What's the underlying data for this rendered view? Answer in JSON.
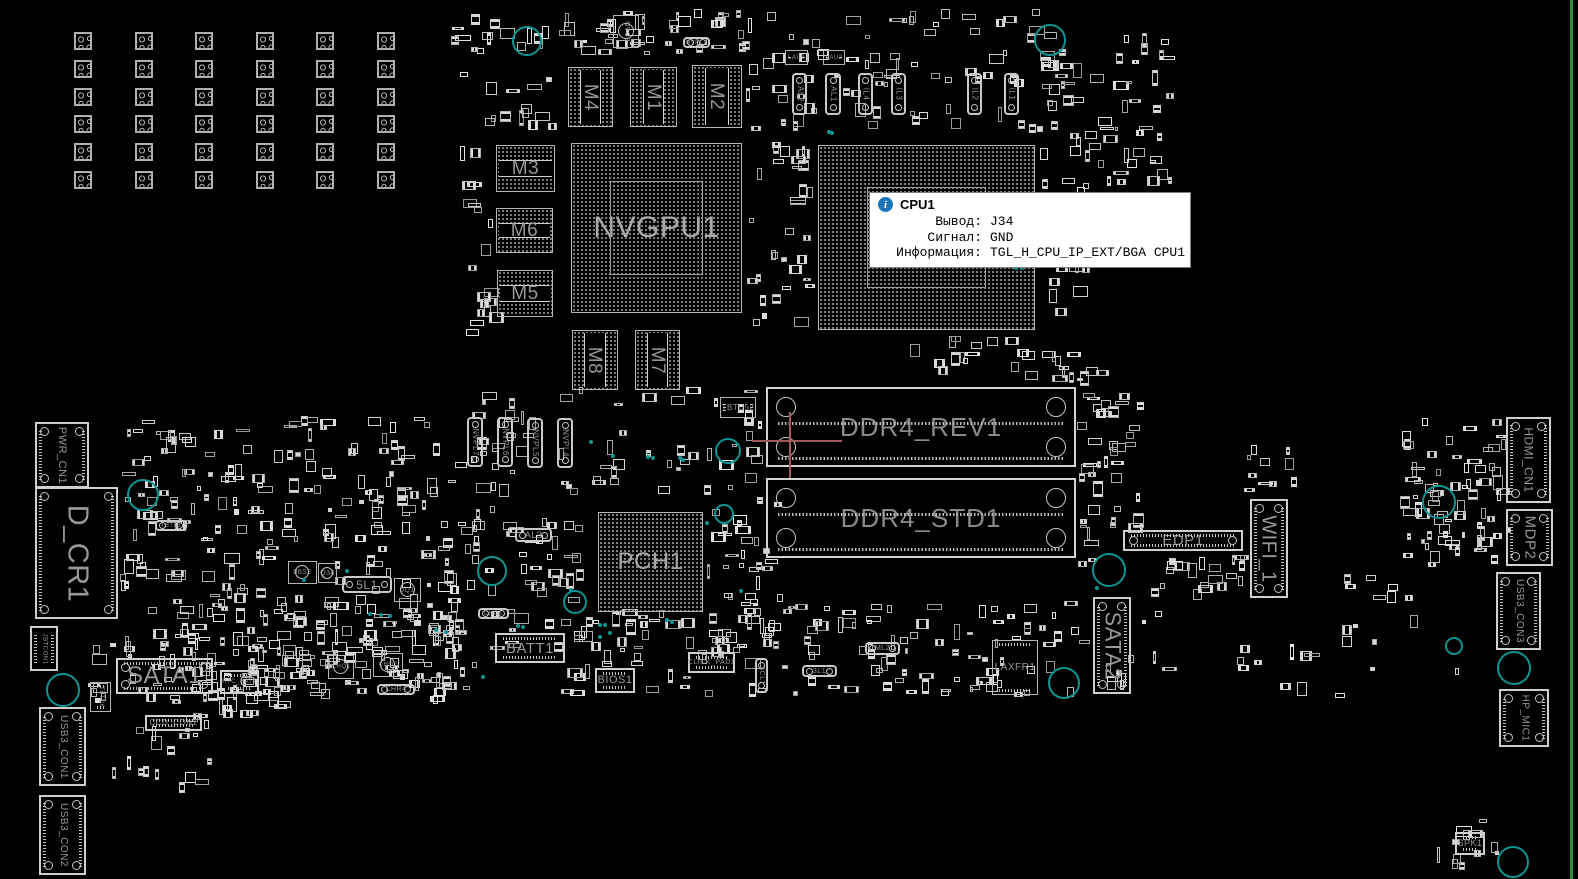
{
  "board": {
    "width": 1578,
    "height": 879,
    "bg": "#000000",
    "silk": "#c0c0c0",
    "label_color": "#989898",
    "teal": "#0d9494",
    "edge_green": "#2e8b2e",
    "crosshair_color": "#a05a5a"
  },
  "tooltip": {
    "title": "CPU1",
    "icon": "info-icon",
    "accent": "#1b75bb",
    "rows": [
      {
        "label": "Вывод:",
        "value": "J34"
      },
      {
        "label": "Сигнал:",
        "value": "GND"
      },
      {
        "label": "Информация:",
        "value": "TGL_H_CPU_IP_EXT/BGA CPU1"
      }
    ]
  },
  "pad_grid": {
    "x": 74,
    "y": 32,
    "cols": 6,
    "rows": 6,
    "dx": 60.5,
    "dy": 27.8,
    "size": 18
  },
  "crosshair": {
    "x": 790,
    "y": 441,
    "h": [
      752,
      440,
      90,
      2
    ],
    "v": [
      789,
      412,
      2,
      66
    ]
  },
  "edge_line": {
    "x": 1570,
    "w": 3
  },
  "components": [
    {
      "id": "nvgpu1",
      "label": "NVGPU1",
      "x": 571,
      "y": 143,
      "w": 171,
      "h": 170,
      "type": "bga",
      "lo": "h",
      "fs": 30,
      "inner": true
    },
    {
      "id": "cpu1",
      "label": "",
      "x": 818,
      "y": 145,
      "w": 217,
      "h": 185,
      "type": "bga",
      "lo": "h",
      "fs": 0,
      "inner": true
    },
    {
      "id": "pch1",
      "label": "PCH1",
      "x": 598,
      "y": 512,
      "w": 105,
      "h": 100,
      "type": "bga",
      "lo": "h",
      "fs": 24
    },
    {
      "id": "m4",
      "label": "M4",
      "x": 568,
      "y": 67,
      "w": 45,
      "h": 60,
      "type": "mem",
      "lo": "v",
      "fs": 19
    },
    {
      "id": "m1",
      "label": "M1",
      "x": 630,
      "y": 67,
      "w": 47,
      "h": 60,
      "type": "mem",
      "lo": "v",
      "fs": 19
    },
    {
      "id": "m2",
      "label": "M2",
      "x": 692,
      "y": 65,
      "w": 50,
      "h": 63,
      "type": "mem",
      "lo": "v",
      "fs": 19
    },
    {
      "id": "m3",
      "label": "M3",
      "x": 496,
      "y": 145,
      "w": 59,
      "h": 47,
      "type": "mem",
      "lo": "h",
      "fs": 19
    },
    {
      "id": "m6",
      "label": "M6",
      "x": 496,
      "y": 208,
      "w": 57,
      "h": 45,
      "type": "mem",
      "lo": "h",
      "fs": 19
    },
    {
      "id": "m5",
      "label": "M5",
      "x": 497,
      "y": 270,
      "w": 56,
      "h": 47,
      "type": "mem",
      "lo": "h",
      "fs": 19
    },
    {
      "id": "m8",
      "label": "M8",
      "x": 572,
      "y": 330,
      "w": 46,
      "h": 60,
      "type": "mem",
      "lo": "v",
      "fs": 19
    },
    {
      "id": "m7",
      "label": "M7",
      "x": 635,
      "y": 330,
      "w": 45,
      "h": 60,
      "type": "mem",
      "lo": "v",
      "fs": 19
    },
    {
      "id": "ddr4_rev1",
      "label": "DDR4_REV1",
      "x": 766,
      "y": 387,
      "w": 310,
      "h": 80,
      "type": "dimm",
      "lo": "h",
      "fs": 26
    },
    {
      "id": "ddr4_std1",
      "label": "DDR4_STD1",
      "x": 766,
      "y": 478,
      "w": 310,
      "h": 80,
      "type": "dimm",
      "lo": "h",
      "fs": 26
    },
    {
      "id": "sata1",
      "label": "SATA1",
      "x": 116,
      "y": 658,
      "w": 97,
      "h": 36,
      "type": "conn",
      "lo": "h",
      "fs": 24
    },
    {
      "id": "sata2",
      "label": "SATA2",
      "x": 1093,
      "y": 597,
      "w": 38,
      "h": 97,
      "type": "conn",
      "lo": "v",
      "fs": 22
    },
    {
      "id": "edp1",
      "label": "EDP1",
      "x": 1123,
      "y": 530,
      "w": 120,
      "h": 21,
      "type": "conn",
      "lo": "h",
      "fs": 15
    },
    {
      "id": "wifi_1",
      "label": "WIFI_1",
      "x": 1250,
      "y": 499,
      "w": 38,
      "h": 99,
      "type": "conn",
      "lo": "v",
      "fs": 20
    },
    {
      "id": "laxfr1",
      "label": "LAXFR1",
      "x": 992,
      "y": 640,
      "w": 46,
      "h": 55,
      "type": "chip",
      "lo": "h",
      "fs": 10
    },
    {
      "id": "d_cr1",
      "label": "D_CR1",
      "x": 35,
      "y": 487,
      "w": 83,
      "h": 132,
      "type": "conn",
      "lo": "v",
      "fs": 29
    },
    {
      "id": "pwr_cn1",
      "label": "PWR_CN1",
      "x": 35,
      "y": 422,
      "w": 54,
      "h": 66,
      "type": "conn",
      "lo": "v",
      "fs": 11
    },
    {
      "id": "hdmi_cn1",
      "label": "HDMI_CN1",
      "x": 1506,
      "y": 417,
      "w": 45,
      "h": 86,
      "type": "conn",
      "lo": "v",
      "fs": 12
    },
    {
      "id": "mdp2",
      "label": "MDP2",
      "x": 1506,
      "y": 509,
      "w": 47,
      "h": 57,
      "type": "conn",
      "lo": "v",
      "fs": 15
    },
    {
      "id": "usb3_con3",
      "label": "USB3_CON3",
      "x": 1496,
      "y": 572,
      "w": 45,
      "h": 78,
      "type": "conn",
      "lo": "v",
      "fs": 10
    },
    {
      "id": "hp_mic1",
      "label": "HP_MIC1",
      "x": 1499,
      "y": 689,
      "w": 50,
      "h": 58,
      "type": "conn",
      "lo": "v",
      "fs": 10
    },
    {
      "id": "spk1",
      "label": "SPK1",
      "x": 1455,
      "y": 832,
      "w": 30,
      "h": 23,
      "type": "conn",
      "lo": "h",
      "fs": 9
    },
    {
      "id": "usb3_con1",
      "label": "USB3_CON1",
      "x": 39,
      "y": 707,
      "w": 47,
      "h": 79,
      "type": "conn",
      "lo": "v",
      "fs": 10
    },
    {
      "id": "usb3_con2",
      "label": "USB3_CON2",
      "x": 39,
      "y": 795,
      "w": 47,
      "h": 80,
      "type": "conn",
      "lo": "v",
      "fs": 10
    },
    {
      "id": "batt1",
      "label": "BATT1",
      "x": 495,
      "y": 633,
      "w": 70,
      "h": 30,
      "type": "conn",
      "lo": "h",
      "fs": 15
    },
    {
      "id": "bios1",
      "label": "BIOS1",
      "x": 595,
      "y": 668,
      "w": 40,
      "h": 25,
      "type": "conn",
      "lo": "h",
      "fs": 11
    },
    {
      "id": "click_pad1",
      "label": "CLICK_PAD1",
      "x": 688,
      "y": 652,
      "w": 47,
      "h": 21,
      "type": "conn",
      "lo": "h",
      "fs": 7
    },
    {
      "id": "ccd_con1",
      "label": "CCD_CON1",
      "x": 145,
      "y": 715,
      "w": 57,
      "h": 16,
      "type": "conn",
      "lo": "h",
      "fs": 8
    },
    {
      "id": "rtc_batt",
      "label": "RTC_BATT",
      "x": 220,
      "y": 670,
      "w": 39,
      "h": 24,
      "type": "conn",
      "lo": "h",
      "fs": 6
    },
    {
      "id": "jbtcon1",
      "label": "JBTCON1",
      "x": 30,
      "y": 626,
      "w": 28,
      "h": 45,
      "type": "conn",
      "lo": "v",
      "fs": 6
    },
    {
      "id": "tbtu52",
      "label": "TBTU52",
      "x": 720,
      "y": 397,
      "w": 36,
      "h": 21,
      "type": "chip",
      "lo": "h",
      "fs": 8
    },
    {
      "id": "tbtu6",
      "label": "TBTU6",
      "x": 90,
      "y": 682,
      "w": 21,
      "h": 30,
      "type": "chip",
      "lo": "v",
      "fs": 6
    },
    {
      "id": "nvc2",
      "label": "NVC2",
      "x": 613,
      "y": 15,
      "w": 26,
      "h": 33,
      "type": "sq",
      "lo": "v",
      "fs": 7
    },
    {
      "id": "lau3",
      "label": "LAU3",
      "x": 785,
      "y": 50,
      "w": 23,
      "h": 15,
      "type": "chip",
      "lo": "h",
      "fs": 6
    },
    {
      "id": "lau2",
      "label": "LAU2",
      "x": 823,
      "y": 50,
      "w": 22,
      "h": 15,
      "type": "chip",
      "lo": "h",
      "fs": 6
    },
    {
      "id": "al2",
      "label": "AL2",
      "x": 792,
      "y": 73,
      "w": 15,
      "h": 42,
      "type": "pill",
      "lo": "v",
      "fs": 8
    },
    {
      "id": "al1",
      "label": "AL1",
      "x": 825,
      "y": 73,
      "w": 16,
      "h": 42,
      "type": "pill",
      "lo": "v",
      "fs": 8
    },
    {
      "id": "il4",
      "label": "IL4",
      "x": 858,
      "y": 73,
      "w": 15,
      "h": 42,
      "type": "pill",
      "lo": "v",
      "fs": 8
    },
    {
      "id": "il3",
      "label": "IL3",
      "x": 891,
      "y": 73,
      "w": 15,
      "h": 42,
      "type": "pill",
      "lo": "v",
      "fs": 8
    },
    {
      "id": "il2",
      "label": "IL2",
      "x": 967,
      "y": 73,
      "w": 15,
      "h": 42,
      "type": "pill",
      "lo": "v",
      "fs": 8
    },
    {
      "id": "il1",
      "label": "IL1",
      "x": 1004,
      "y": 73,
      "w": 15,
      "h": 42,
      "type": "pill",
      "lo": "v",
      "fs": 8
    },
    {
      "id": "nvpl7",
      "label": "NVPL7",
      "x": 467,
      "y": 417,
      "w": 16,
      "h": 50,
      "type": "pill",
      "lo": "v",
      "fs": 8
    },
    {
      "id": "nvpl6",
      "label": "NVPL6",
      "x": 497,
      "y": 417,
      "w": 16,
      "h": 50,
      "type": "pill",
      "lo": "v",
      "fs": 8
    },
    {
      "id": "nvpl5",
      "label": "NVPL5",
      "x": 527,
      "y": 418,
      "w": 16,
      "h": 50,
      "type": "pill",
      "lo": "v",
      "fs": 8
    },
    {
      "id": "nvpl4",
      "label": "NVPL4",
      "x": 557,
      "y": 418,
      "w": 16,
      "h": 50,
      "type": "pill",
      "lo": "v",
      "fs": 8
    },
    {
      "id": "3cl1",
      "label": "3CL1",
      "x": 755,
      "y": 658,
      "w": 13,
      "h": 35,
      "type": "pill",
      "lo": "v",
      "fs": 7
    },
    {
      "id": "al3",
      "label": "AL3",
      "x": 515,
      "y": 528,
      "w": 37,
      "h": 14,
      "type": "pill",
      "lo": "h",
      "fs": 9
    },
    {
      "id": "5l1",
      "label": "5L1",
      "x": 342,
      "y": 576,
      "w": 50,
      "h": 17,
      "type": "pill",
      "lo": "h",
      "fs": 12
    },
    {
      "id": "chck",
      "label": "CHCK",
      "x": 478,
      "y": 608,
      "w": 31,
      "h": 11,
      "type": "pill",
      "lo": "h",
      "fs": 6
    },
    {
      "id": "tbtl3",
      "label": "TBTL3",
      "x": 155,
      "y": 520,
      "w": 32,
      "h": 11,
      "type": "pill",
      "lo": "h",
      "fs": 6
    },
    {
      "id": "3l1",
      "label": "3L1",
      "x": 802,
      "y": 665,
      "w": 35,
      "h": 12,
      "type": "pill",
      "lo": "h",
      "fs": 7
    },
    {
      "id": "ml2",
      "label": "ML2",
      "x": 865,
      "y": 642,
      "w": 35,
      "h": 13,
      "type": "pill",
      "lo": "h",
      "fs": 7
    },
    {
      "id": "chr4",
      "label": "CHR4",
      "x": 377,
      "y": 684,
      "w": 38,
      "h": 11,
      "type": "pill",
      "lo": "h",
      "fs": 7
    },
    {
      "id": "nvpl1",
      "label": "NVPL1",
      "x": 683,
      "y": 37,
      "w": 27,
      "h": 11,
      "type": "pill",
      "lo": "h",
      "fs": 6
    },
    {
      "id": "q34",
      "label": "Q34",
      "x": 318,
      "y": 563,
      "w": 19,
      "h": 20,
      "type": "sq",
      "lo": "h",
      "fs": 7
    },
    {
      "id": "06s2",
      "label": "06S2",
      "x": 288,
      "y": 561,
      "w": 29,
      "h": 23,
      "type": "sq",
      "lo": "h",
      "fs": 7
    },
    {
      "id": "5q1",
      "label": "5Q1",
      "x": 394,
      "y": 578,
      "w": 27,
      "h": 24,
      "type": "sq",
      "lo": "h",
      "fs": 7
    },
    {
      "id": "chq1",
      "label": "CHQ1",
      "x": 328,
      "y": 655,
      "w": 26,
      "h": 24,
      "type": "sq",
      "lo": "h",
      "fs": 6
    },
    {
      "id": "chq2",
      "label": "CHQ2",
      "x": 373,
      "y": 653,
      "w": 30,
      "h": 24,
      "type": "sq",
      "lo": "h",
      "fs": 6
    }
  ],
  "vias": [
    [
      527,
      41,
      15
    ],
    [
      1050,
      40,
      16
    ],
    [
      143,
      495,
      16
    ],
    [
      492,
      571,
      15
    ],
    [
      575,
      602,
      12
    ],
    [
      724,
      514,
      10
    ],
    [
      728,
      451,
      13
    ],
    [
      1109,
      570,
      17
    ],
    [
      63,
      690,
      17
    ],
    [
      1064,
      683,
      16
    ],
    [
      1439,
      502,
      17
    ],
    [
      1454,
      646,
      9
    ],
    [
      1514,
      668,
      17
    ],
    [
      1513,
      862,
      16
    ]
  ],
  "teal_dots": [
    [
      370,
      614
    ],
    [
      381,
      615
    ],
    [
      390,
      616
    ],
    [
      667,
      620
    ],
    [
      672,
      622
    ],
    [
      600,
      625
    ],
    [
      605,
      625
    ],
    [
      610,
      633
    ],
    [
      600,
      637
    ],
    [
      483,
      677
    ],
    [
      518,
      626
    ],
    [
      523,
      627
    ],
    [
      571,
      590
    ],
    [
      829,
      132
    ],
    [
      832,
      133
    ],
    [
      591,
      442
    ],
    [
      613,
      456
    ],
    [
      648,
      457
    ],
    [
      653,
      458
    ],
    [
      680,
      458
    ],
    [
      683,
      460
    ],
    [
      1016,
      268
    ],
    [
      1022,
      268
    ],
    [
      1097,
      588
    ],
    [
      707,
      523
    ],
    [
      741,
      591
    ],
    [
      436,
      630
    ],
    [
      446,
      632
    ],
    [
      304,
      580
    ],
    [
      347,
      571
    ]
  ],
  "clutter_regions": [
    {
      "x": 450,
      "y": 8,
      "w": 300,
      "h": 48,
      "n": 55
    },
    {
      "x": 455,
      "y": 60,
      "w": 108,
      "h": 72,
      "n": 14
    },
    {
      "x": 745,
      "y": 8,
      "w": 330,
      "h": 125,
      "n": 85
    },
    {
      "x": 1040,
      "y": 25,
      "w": 140,
      "h": 175,
      "n": 55
    },
    {
      "x": 120,
      "y": 415,
      "w": 340,
      "h": 290,
      "n": 300
    },
    {
      "x": 455,
      "y": 385,
      "w": 320,
      "h": 112,
      "n": 65
    },
    {
      "x": 440,
      "y": 505,
      "w": 152,
      "h": 148,
      "n": 60
    },
    {
      "x": 705,
      "y": 495,
      "w": 78,
      "h": 168,
      "n": 42
    },
    {
      "x": 230,
      "y": 600,
      "w": 250,
      "h": 100,
      "n": 70
    },
    {
      "x": 560,
      "y": 602,
      "w": 425,
      "h": 95,
      "n": 105
    },
    {
      "x": 745,
      "y": 140,
      "w": 70,
      "h": 188,
      "n": 32
    },
    {
      "x": 1040,
      "y": 348,
      "w": 70,
      "h": 40,
      "n": 12
    },
    {
      "x": 1077,
      "y": 390,
      "w": 70,
      "h": 178,
      "n": 40
    },
    {
      "x": 1135,
      "y": 553,
      "w": 115,
      "h": 48,
      "n": 20
    },
    {
      "x": 1400,
      "y": 418,
      "w": 112,
      "h": 150,
      "n": 72
    },
    {
      "x": 1340,
      "y": 558,
      "w": 130,
      "h": 128,
      "n": 14
    },
    {
      "x": 88,
      "y": 640,
      "w": 205,
      "h": 78,
      "n": 48
    },
    {
      "x": 108,
      "y": 700,
      "w": 125,
      "h": 95,
      "n": 20
    },
    {
      "x": 1437,
      "y": 815,
      "w": 62,
      "h": 55,
      "n": 12
    },
    {
      "x": 975,
      "y": 600,
      "w": 205,
      "h": 98,
      "n": 40
    },
    {
      "x": 460,
      "y": 278,
      "w": 52,
      "h": 60,
      "n": 10
    },
    {
      "x": 1240,
      "y": 440,
      "w": 60,
      "h": 55,
      "n": 10
    },
    {
      "x": 900,
      "y": 335,
      "w": 140,
      "h": 48,
      "n": 16
    },
    {
      "x": 458,
      "y": 140,
      "w": 35,
      "h": 140,
      "n": 10
    },
    {
      "x": 1230,
      "y": 640,
      "w": 120,
      "h": 60,
      "n": 10
    },
    {
      "x": 1045,
      "y": 260,
      "w": 55,
      "h": 70,
      "n": 8
    }
  ]
}
